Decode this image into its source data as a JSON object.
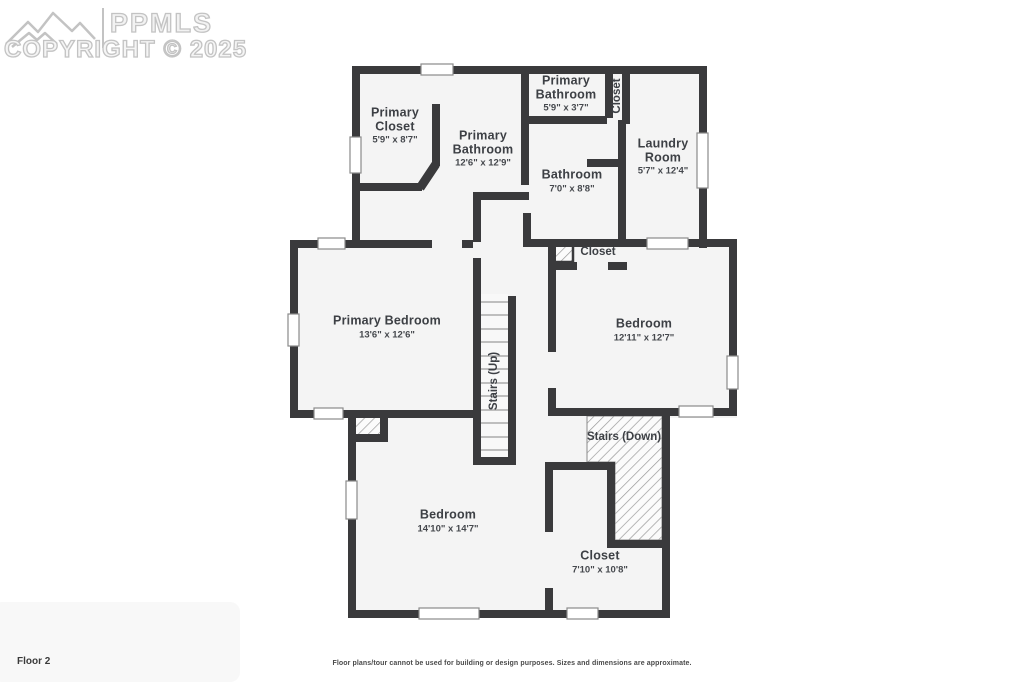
{
  "watermark": {
    "logo_text": "PPMLS",
    "copyright": "COPYRIGHT © 2025"
  },
  "floor_label": "Floor 2",
  "disclaimer": "Floor plans/tour cannot be used for building or design purposes. Sizes and dimensions are approximate.",
  "rooms": {
    "primary_closet": {
      "name": "Primary Closet",
      "dims": "5'9\" x 8'7\""
    },
    "primary_bathroom_main": {
      "name": "Primary Bathroom",
      "dims": "12'6\" x 12'9\""
    },
    "primary_bathroom_small": {
      "name": "Primary Bathroom",
      "dims": "5'9\" x 3'7\""
    },
    "closet_top": {
      "name": "Closet"
    },
    "laundry_room": {
      "name": "Laundry Room",
      "dims": "5'7\" x 12'4\""
    },
    "bathroom": {
      "name": "Bathroom",
      "dims": "7'0\" x 8'8\""
    },
    "closet_mid": {
      "name": "Closet"
    },
    "primary_bedroom": {
      "name": "Primary Bedroom",
      "dims": "13'6\" x 12'6\""
    },
    "bedroom_mid": {
      "name": "Bedroom",
      "dims": "12'11\" x 12'7\""
    },
    "stairs_up": {
      "name": "Stairs (Up)"
    },
    "stairs_down": {
      "name": "Stairs (Down)"
    },
    "bedroom_bottom": {
      "name": "Bedroom",
      "dims": "14'10\" x 14'7\""
    },
    "closet_bottom": {
      "name": "Closet",
      "dims": "7'10\" x 10'8\""
    }
  },
  "colors": {
    "wall": "#3a3a3c",
    "floor": "#f4f4f4",
    "background": "#ffffff",
    "hatch_line": "#9a9a9a",
    "label_text": "#3d4045",
    "watermark_gray": "#c3c3c3"
  }
}
